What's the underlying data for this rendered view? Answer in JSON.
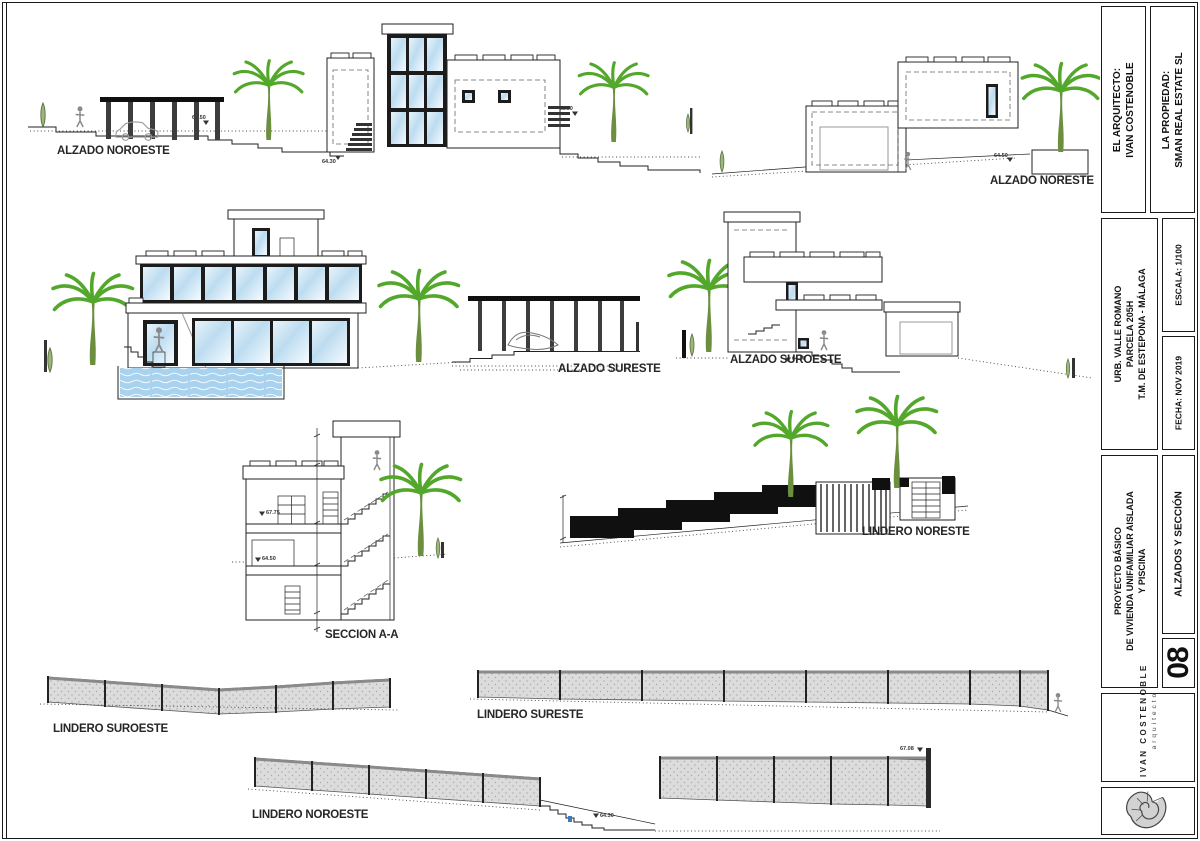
{
  "sheet": {
    "bg": "#ffffff",
    "line_color": "#222222",
    "palm_color": "#53a82b",
    "glass_color": "#bddcf0",
    "pool_color": "#a8d2ee",
    "fence_fill": "#dcdcdc"
  },
  "drawings": {
    "alzado_noroeste": {
      "label": "ALZADO NOROESTE"
    },
    "alzado_noreste": {
      "label": "ALZADO NORESTE"
    },
    "alzado_sureste": {
      "label": "ALZADO SURESTE"
    },
    "alzado_suroeste": {
      "label": "ALZADO SUROESTE"
    },
    "seccion": {
      "label": "SECCION A-A"
    },
    "lindero_noreste": {
      "label": "LINDERO NORESTE"
    },
    "lindero_suroeste": {
      "label": "LINDERO SUROESTE"
    },
    "lindero_sureste": {
      "label": "LINDERO SURESTE"
    },
    "lindero_noroeste": {
      "label": "LINDERO NOROESTE"
    }
  },
  "markers": {
    "m1": "68.50",
    "m2": "64.30",
    "m3": "64.50",
    "m4": "67.75",
    "m5": "67.08"
  },
  "title_block": {
    "architect_label": "EL ARQUITECTO:",
    "architect_name": "IVAN COSTENOBLE",
    "property_label": "LA PROPIEDAD:",
    "property_name": "SMAN REAL ESTATE SL",
    "location_line1": "URB. VALLE ROMANO",
    "location_line2": "PARCELA 205H",
    "location_line3": "T.M. DE ESTEPONA - MÁLAGA",
    "scale": "ESCALA: 1/100",
    "date": "FECHA: NOV 2019",
    "project_line1": "PROYECTO BÁSICO",
    "project_line2": "DE VIVIENDA UNIFAMILIAR AISLADA",
    "project_line3": "Y PISCINA",
    "sheet_number": "08",
    "sheet_title": "ALZADOS Y SECCIÓN",
    "firm_name": "IVAN COSTENOBLE",
    "firm_role": "arquitecto"
  }
}
